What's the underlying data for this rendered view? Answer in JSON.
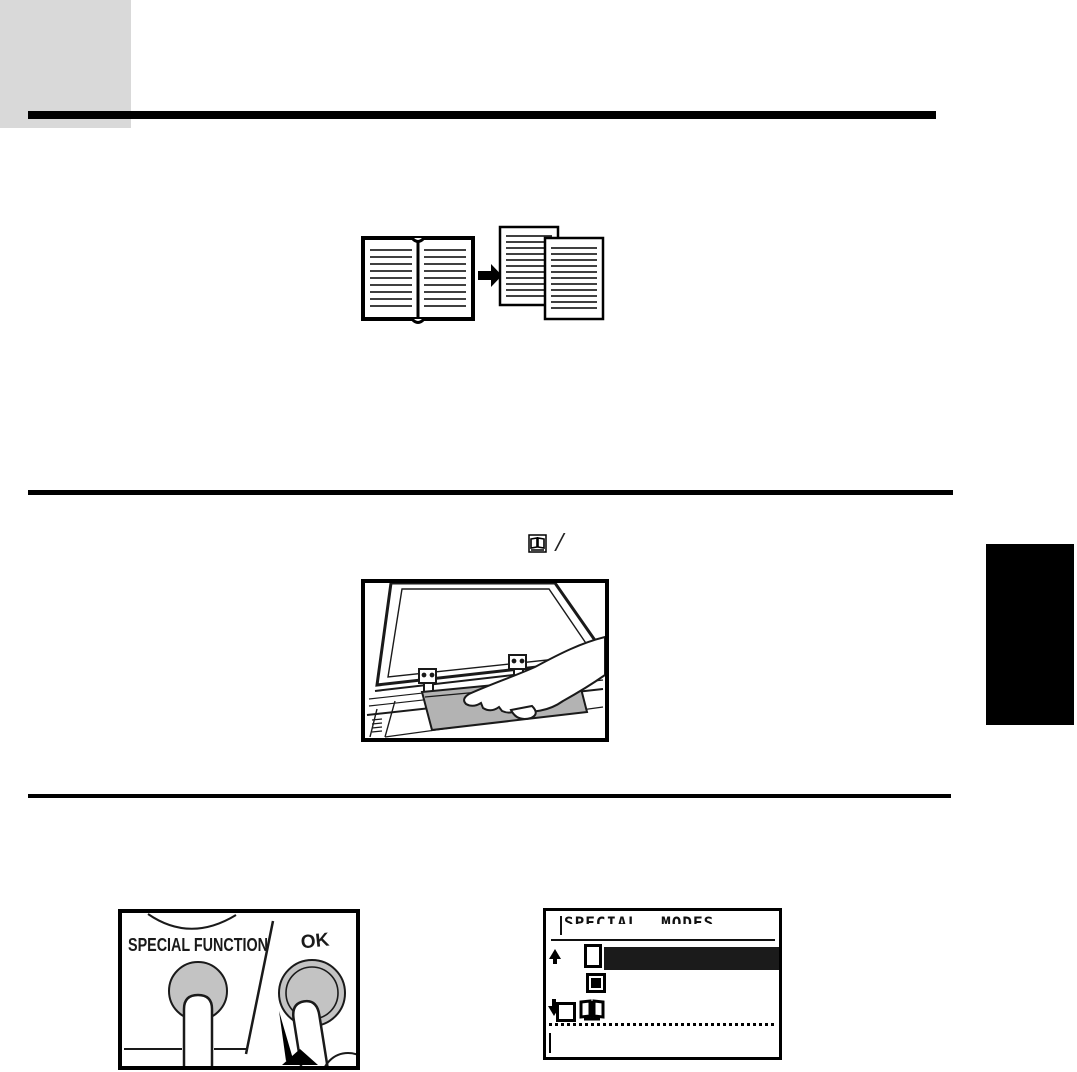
{
  "page": {
    "type": "copier-manual-scan",
    "background": "#ffffff",
    "chapter_tab_color": "#d9d9d9",
    "edge_tab_color": "#000000"
  },
  "instruction_line": {
    "dual_page_key_icon": "open-book-in-box",
    "separator": "/"
  },
  "diagrams": {
    "dual_page_copy": {
      "description": "open book copied onto two separate pages",
      "arrow": "right"
    },
    "placement": {
      "description": "hand placing open book face down on document glass under raised cover"
    }
  },
  "keys_panel": {
    "special_function_label": "SPECIAL FUNCTION",
    "ok_label": "OK",
    "key_color": "#c3c3c3"
  },
  "lcd": {
    "title": "SPECIAL MODES",
    "highlight_color": "#1b1b1b",
    "rows": [
      {
        "icon": "single-page",
        "state": "selected-highlighted"
      },
      {
        "icon": "erase-filled-square",
        "state": "normal"
      },
      {
        "icon": "dual-page-book",
        "state": "normal"
      }
    ]
  }
}
